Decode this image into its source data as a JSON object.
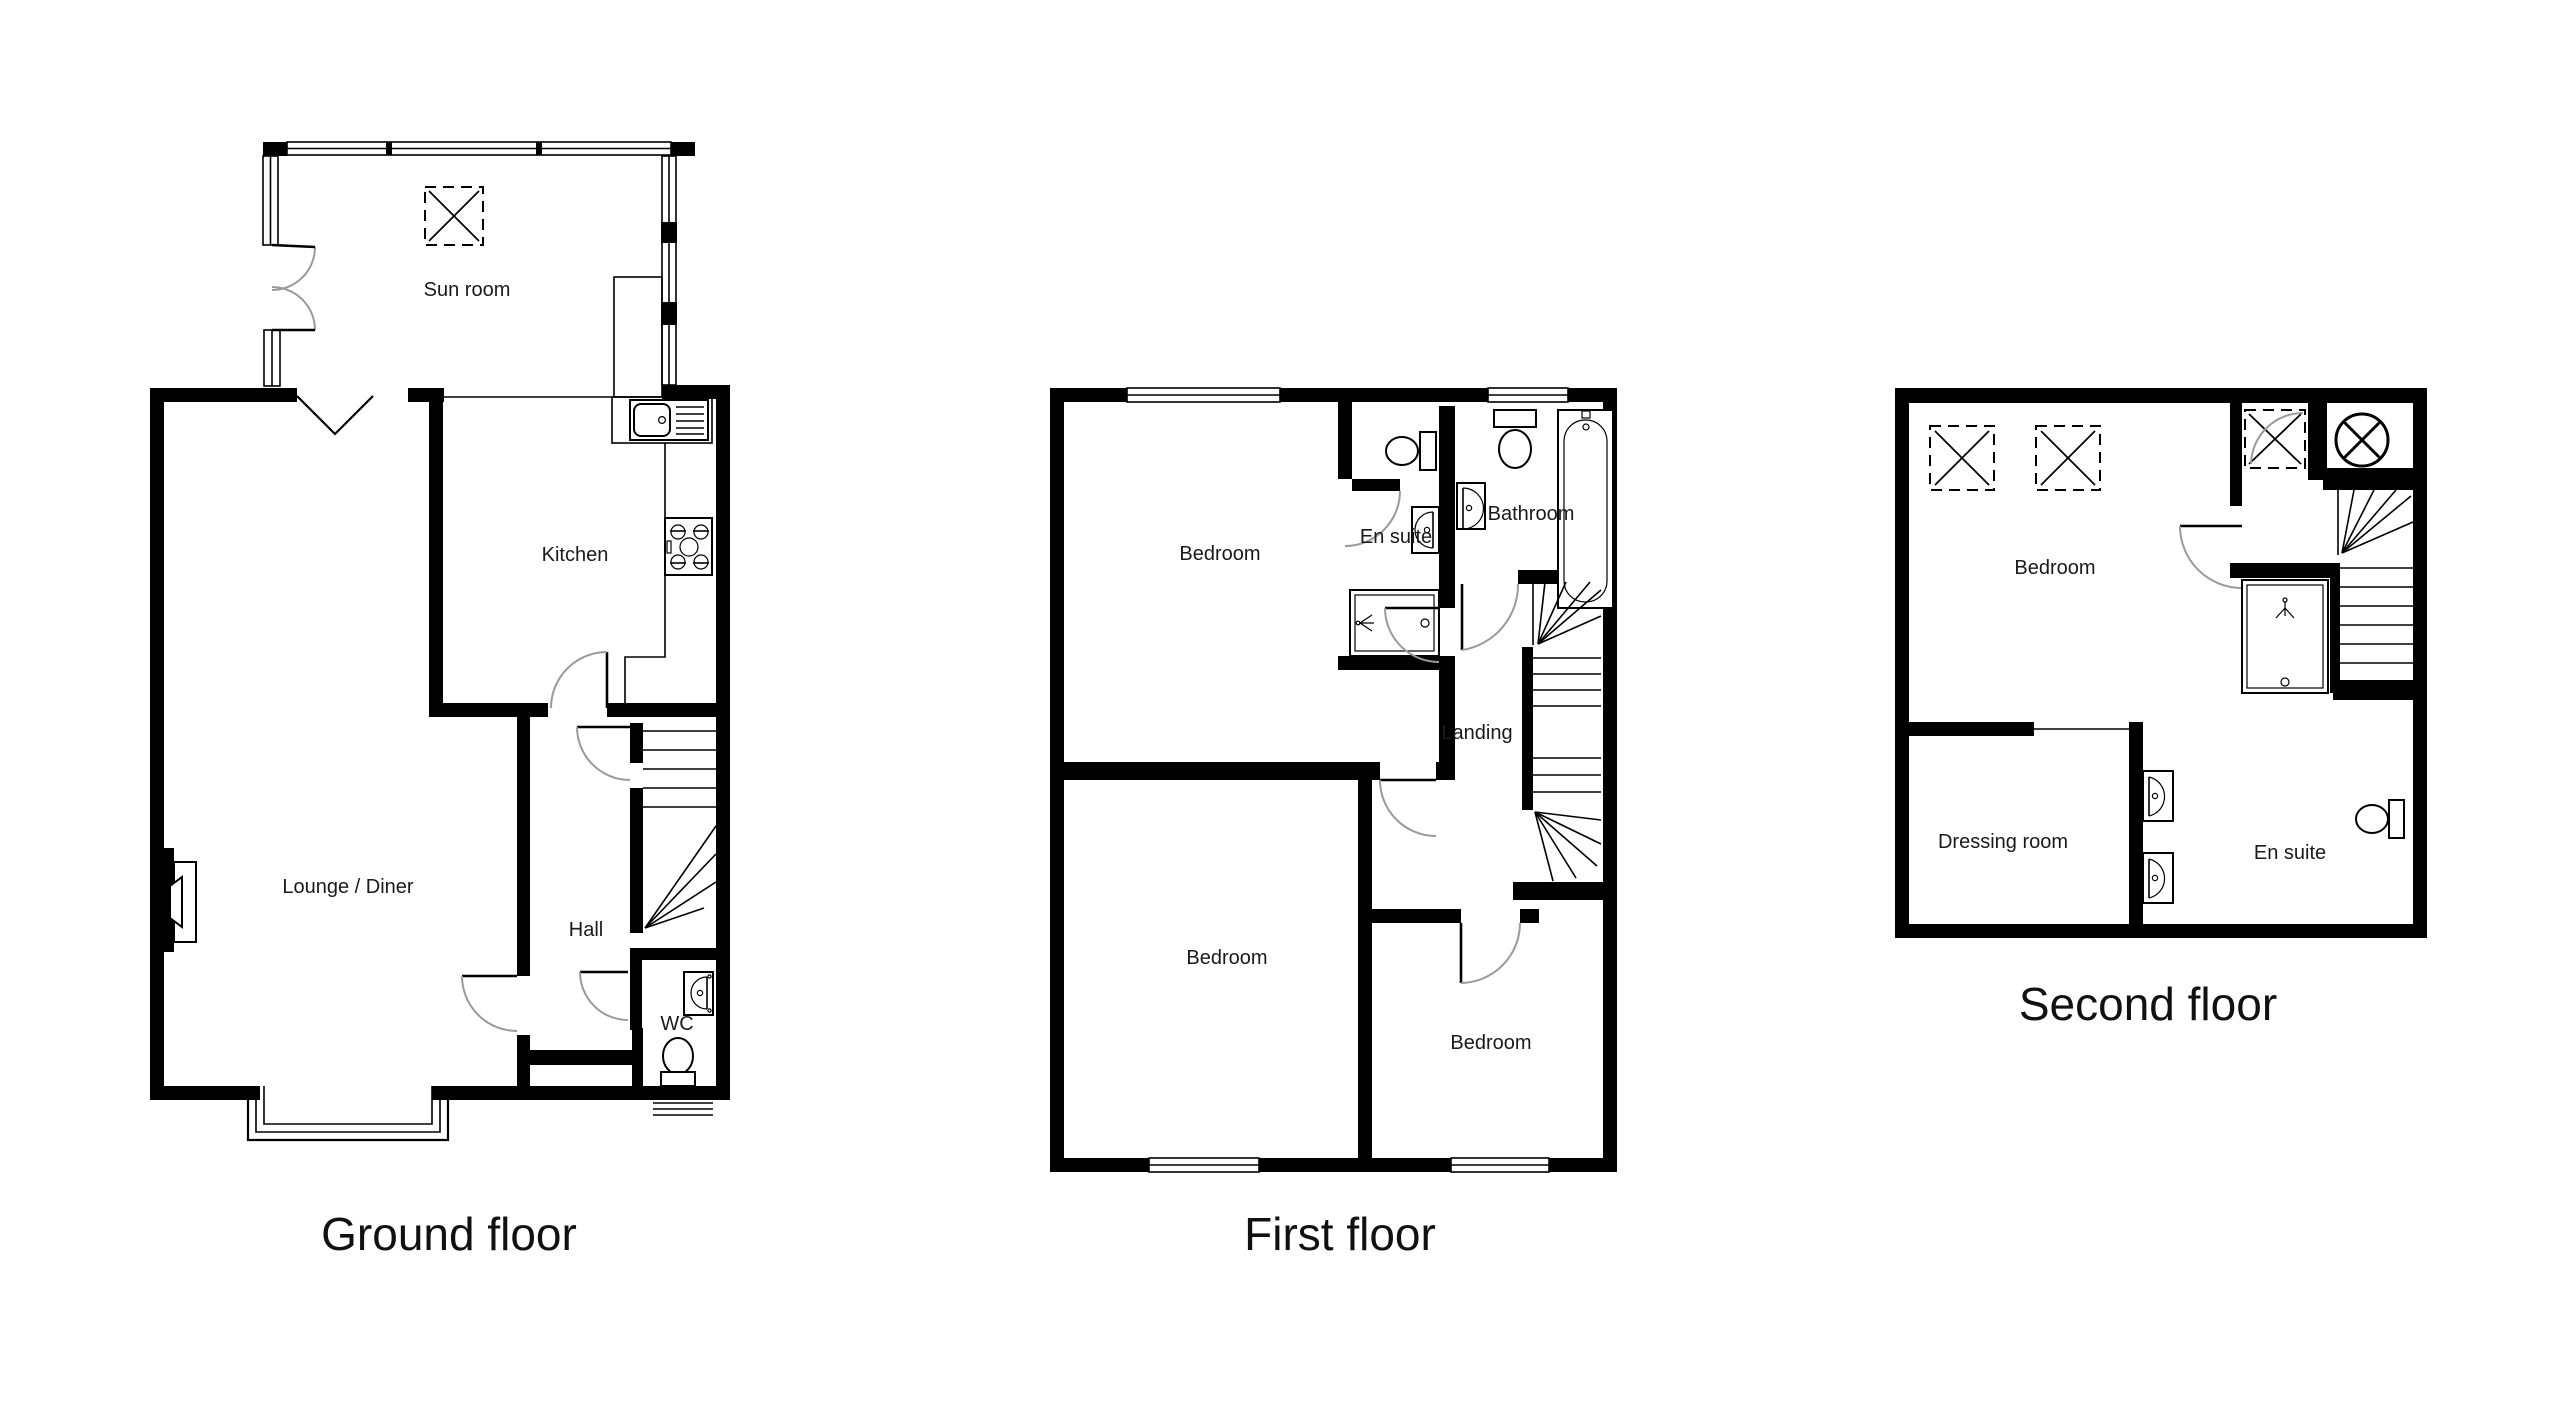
{
  "document": {
    "type": "property-floorplan",
    "background": "#ffffff"
  },
  "colors": {
    "wall": "#000000",
    "line": "#000000",
    "door_arc": "#9a9a9a",
    "text": "#1a1a1a"
  },
  "floors": {
    "ground": {
      "title": "Ground floor",
      "labels": {
        "sun_room": "Sun room",
        "kitchen": "Kitchen",
        "lounge_diner": "Lounge / Diner",
        "hall": "Hall",
        "wc": "WC"
      }
    },
    "first": {
      "title": "First floor",
      "labels": {
        "bedroom_front": "Bedroom",
        "en_suite": "En suite",
        "bathroom": "Bathroom",
        "landing": "Landing",
        "bedroom_back": "Bedroom",
        "bedroom_rear": "Bedroom"
      }
    },
    "second": {
      "title": "Second floor",
      "labels": {
        "bedroom": "Bedroom",
        "dressing_room": "Dressing room",
        "en_suite": "En suite"
      }
    }
  }
}
